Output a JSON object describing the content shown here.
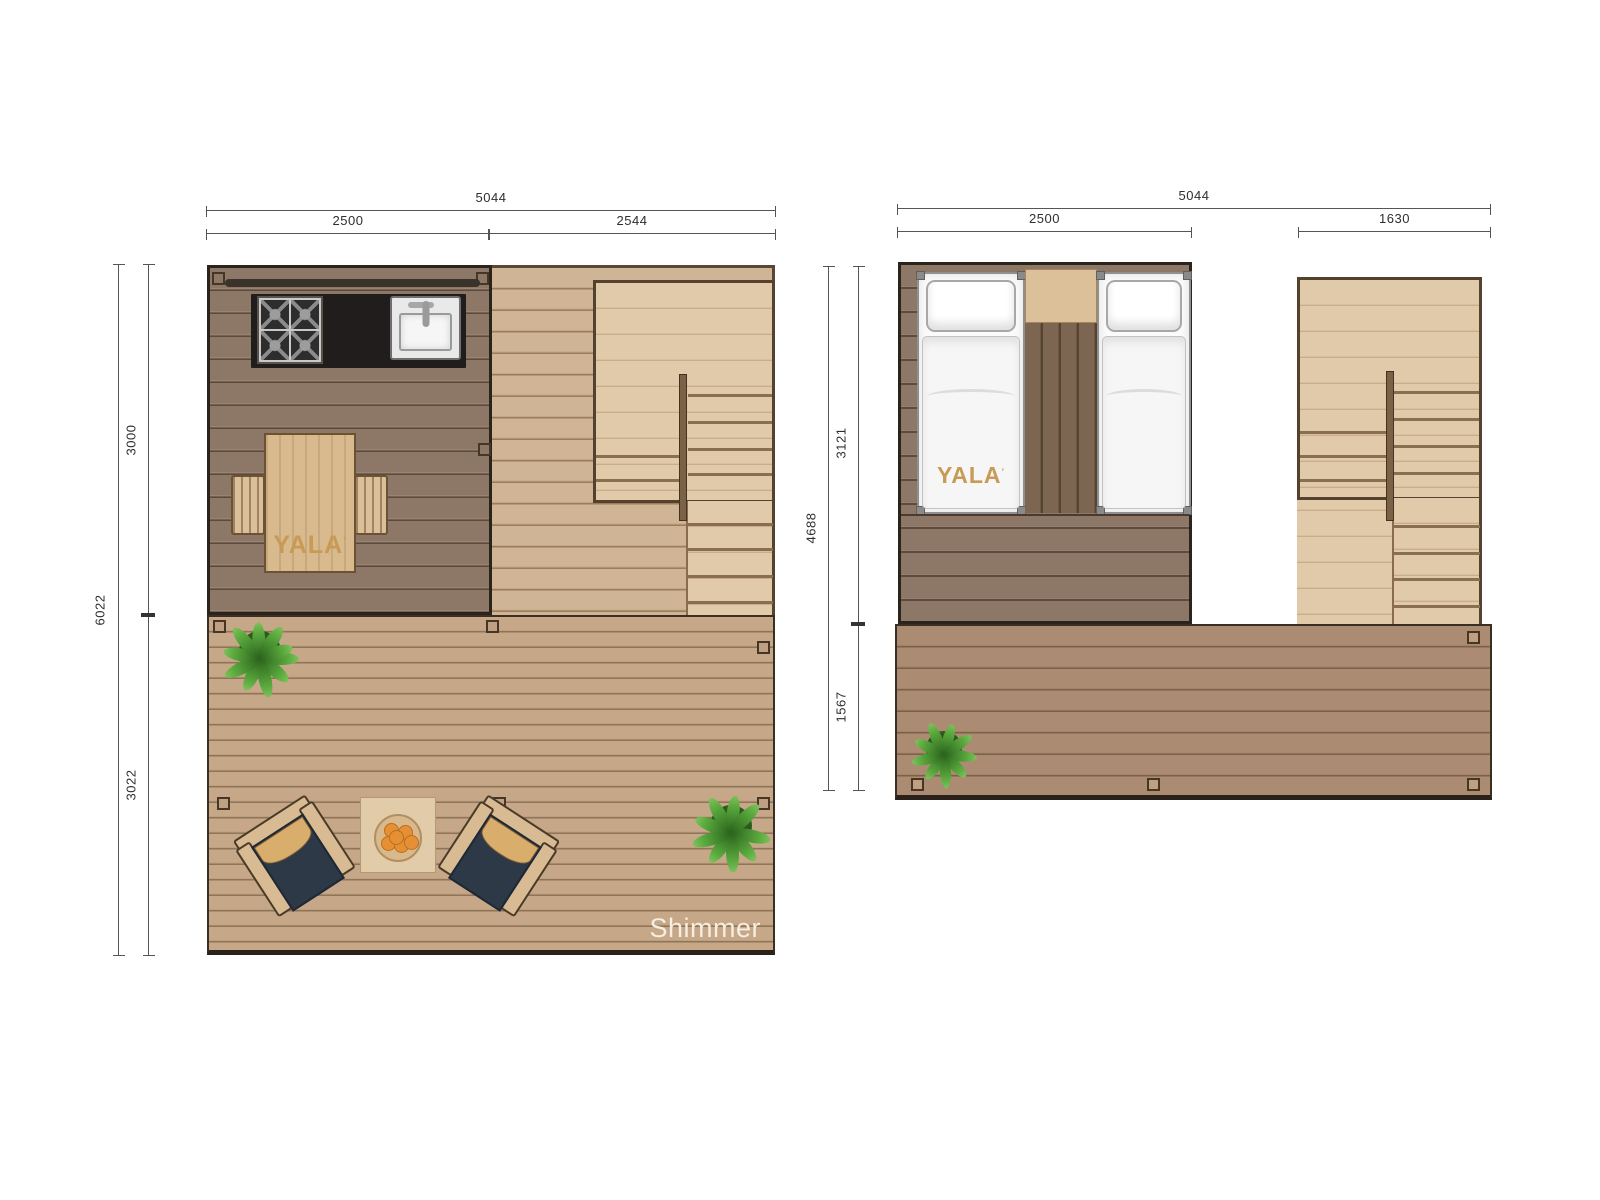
{
  "document": {
    "model_label": "Shimmer"
  },
  "branding": {
    "logo": "YALA",
    "logo_mark": "ʼ"
  },
  "left_plan": {
    "dims": {
      "total_width": "5044",
      "width_left": "2500",
      "width_right": "2544",
      "total_height": "6022",
      "height_top": "3000",
      "height_bottom": "3022"
    }
  },
  "right_plan": {
    "dims": {
      "total_width": "5044",
      "width_left": "2500",
      "width_right": "1630",
      "total_height": "4688",
      "height_top": "3121",
      "height_bottom": "1567"
    }
  },
  "colors": {
    "interior_floor": "#8d7766",
    "deck_left": "#c4a586",
    "deck_right": "#aa8b71",
    "stair_wood": "#e0c9a9",
    "counter_black": "#201d1c",
    "cushion_navy": "#2d3947",
    "logo_gold": "#c79a55",
    "plant_green": "#4f9c38",
    "dimension_line": "#555555",
    "model_text": "#f5eee1"
  }
}
